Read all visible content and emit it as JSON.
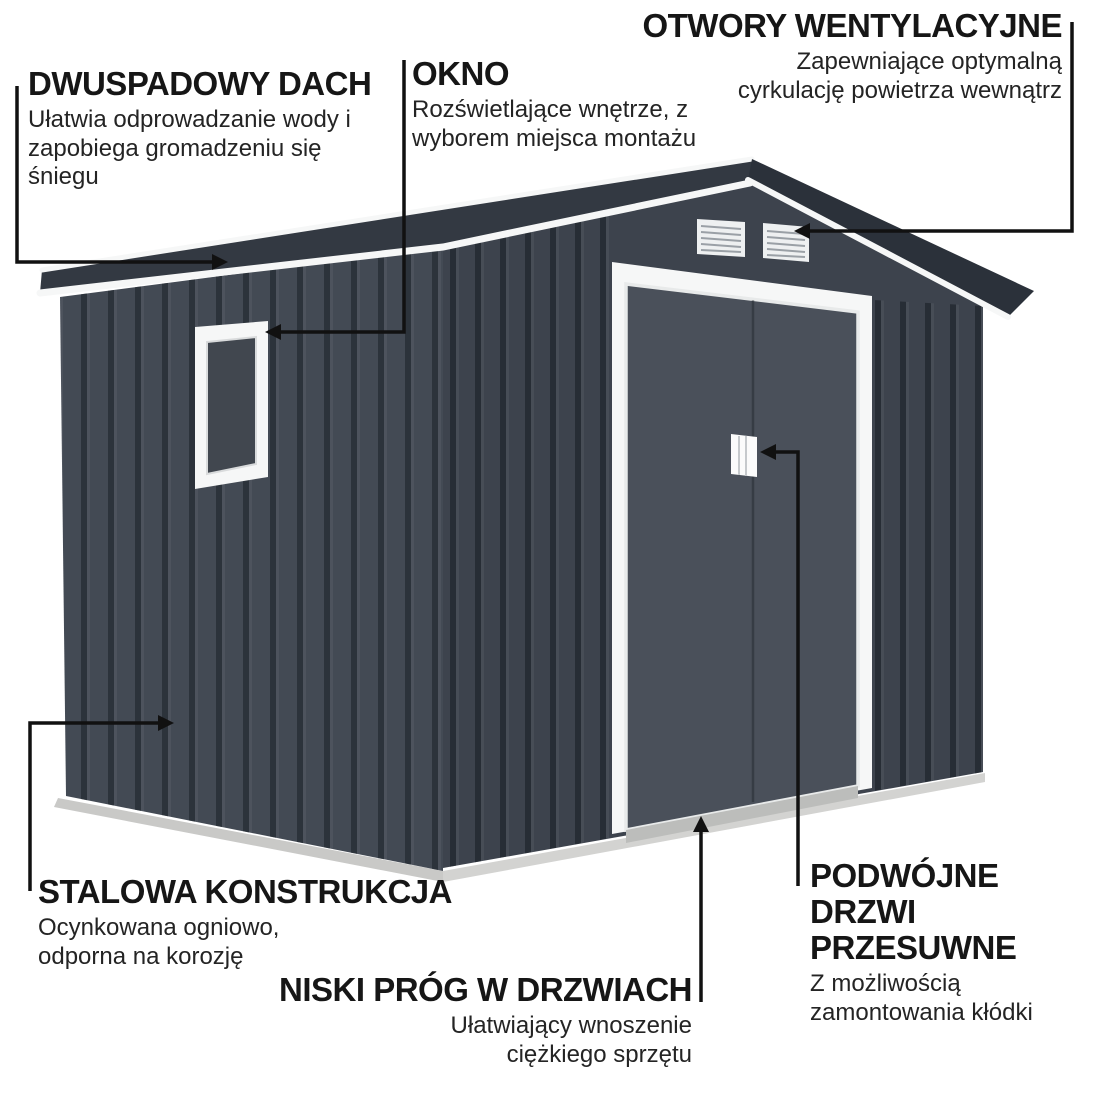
{
  "callouts": {
    "roof": {
      "title": "DWUSPADOWY DACH",
      "description": "Ułatwia odprowadzanie wody i zapobiega gromadzeniu się śniegu"
    },
    "window": {
      "title": "OKNO",
      "description": "Rozświetlające wnętrze, z wyborem miejsca montażu"
    },
    "vents": {
      "title": "OTWORY WENTYLACYJNE",
      "description": "Zapewniające optymalną cyrkulację powietrza wewnątrz"
    },
    "structure": {
      "title": "STALOWA KONSTRUKCJA",
      "description": "Ocynkowana ogniowo, odporna na korozję"
    },
    "threshold": {
      "title": "NISKI PRÓG W DRZWIACH",
      "description": "Ułatwiający wnoszenie ciężkiego sprzętu"
    },
    "doors": {
      "title": "PODWÓJNE DRZWI PRZESUWNE",
      "description": "Z możliwością zamontowania kłódki"
    }
  },
  "colors": {
    "background": "#ffffff",
    "roof_left": "#333942",
    "roof_right": "#2b313a",
    "side_wall": "#434a54",
    "front_wall": "#3d434d",
    "door_panel": "#4a505a",
    "trim_white": "#f6f7f7",
    "base_gray": "#c9c9c7",
    "glass": "#41474f",
    "callout_line": "#111111",
    "text": "#161616"
  }
}
